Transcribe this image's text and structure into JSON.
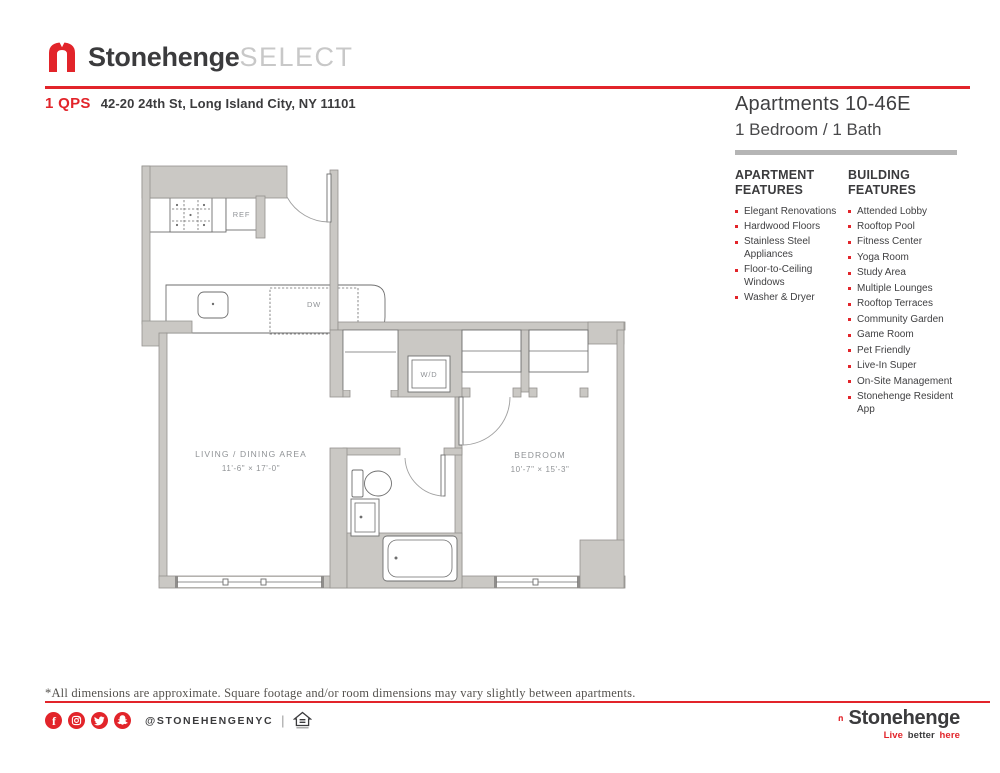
{
  "header": {
    "brand": "Stonehenge",
    "brand_suffix": "SELECT",
    "building_code": "1 QPS",
    "address": "42-20 24th St, Long Island City, NY 11101"
  },
  "unit": {
    "title": "Apartments 10-46E",
    "subtitle": "1 Bedroom / 1 Bath"
  },
  "apartment_features": {
    "heading": "APARTMENT FEATURES",
    "items": [
      "Elegant Renovations",
      "Hardwood Floors",
      "Stainless Steel Appliances",
      "Floor-to-Ceiling Windows",
      "Washer & Dryer"
    ]
  },
  "building_features": {
    "heading": "BUILDING FEATURES",
    "items": [
      "Attended Lobby",
      "Rooftop Pool",
      "Fitness Center",
      "Yoga Room",
      "Study Area",
      "Multiple Lounges",
      "Rooftop Terraces",
      "Community Garden",
      "Game Room",
      "Pet Friendly",
      "Live-In Super",
      "On-Site Management",
      "Stonehenge Resident App"
    ]
  },
  "floorplan": {
    "living": {
      "name": "LIVING / DINING AREA",
      "dims": "11'-6\" × 17'-0\""
    },
    "bedroom": {
      "name": "BEDROOM",
      "dims": "10'-7\" × 15'-3\""
    },
    "labels": {
      "ref": "REF",
      "dw": "DW",
      "wd": "W/D"
    }
  },
  "footer": {
    "disclaimer": "*All dimensions are approximate. Square footage and/or room dimensions may vary slightly between apartments.",
    "social_handle": "@STONEHENGENYC",
    "brand": "Stonehenge",
    "tagline": {
      "live": "Live",
      "better": "better",
      "here": "here"
    }
  },
  "colors": {
    "accent_red": "#e2242a",
    "dark_text": "#3b3b3d",
    "wall_gray": "#cac8c4",
    "select_gray": "#c8c8c8"
  }
}
